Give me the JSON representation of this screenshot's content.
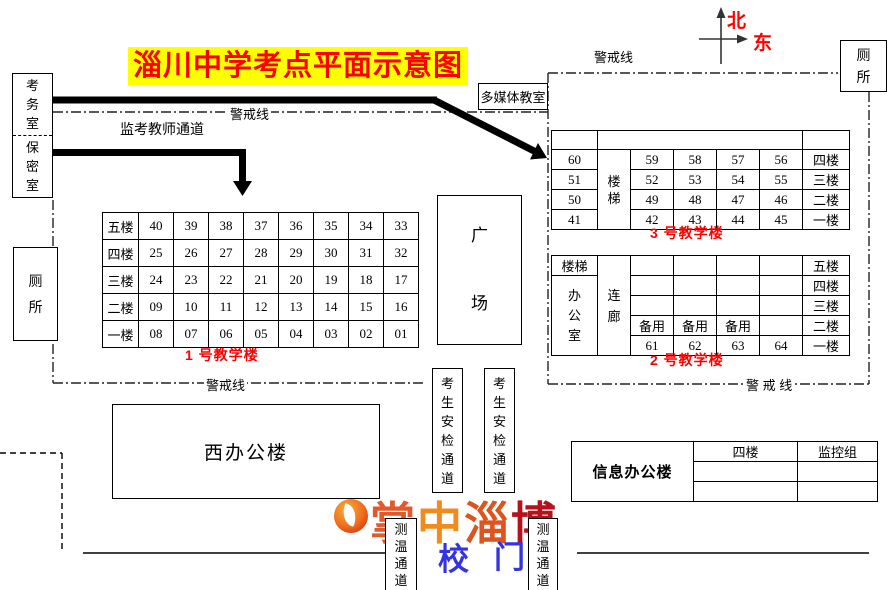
{
  "title": "淄川中学考点平面示意图",
  "compass": {
    "north": "北",
    "east": "东"
  },
  "rooms": {
    "exam_office": "考务室",
    "secrecy_room": "保密室",
    "toilet_left": "厕所",
    "toilet_top_right": "厕所",
    "multimedia": "多媒体教室",
    "square": "广场",
    "west_office": "西办公楼",
    "info_office": "信息办公楼"
  },
  "labels": {
    "cordon_top_left": "警戒线",
    "cordon_top_right": "警戒线",
    "cordon_bottom_left": "警戒线",
    "cordon_bottom_right": "警 戒 线",
    "teacher_passage": "监考教师通道",
    "security_channel": "考生安检通道",
    "temp_channel": "测温通道",
    "gate_left": "校",
    "gate_right": "门"
  },
  "building1": {
    "name": "1 号教学楼",
    "floors": [
      "五楼",
      "四楼",
      "三楼",
      "二楼",
      "一楼"
    ],
    "rows": [
      [
        "40",
        "39",
        "38",
        "37",
        "36",
        "35",
        "34",
        "33"
      ],
      [
        "25",
        "26",
        "27",
        "28",
        "29",
        "30",
        "31",
        "32"
      ],
      [
        "24",
        "23",
        "22",
        "21",
        "20",
        "19",
        "18",
        "17"
      ],
      [
        "09",
        "10",
        "11",
        "12",
        "13",
        "14",
        "15",
        "16"
      ],
      [
        "08",
        "07",
        "06",
        "05",
        "04",
        "03",
        "02",
        "01"
      ]
    ]
  },
  "building3": {
    "name": "3 号教学楼",
    "stairs": "楼梯",
    "floors": [
      "四楼",
      "三楼",
      "二楼",
      "一楼"
    ],
    "left_col": [
      "60",
      "51",
      "50",
      "41"
    ],
    "rows": [
      [
        "59",
        "58",
        "57",
        "56"
      ],
      [
        "52",
        "53",
        "54",
        "55"
      ],
      [
        "49",
        "48",
        "47",
        "46"
      ],
      [
        "42",
        "43",
        "44",
        "45"
      ]
    ]
  },
  "building2": {
    "name": "2 号教学楼",
    "stairs": "楼梯",
    "office": "办公室",
    "corridor": "连廊",
    "floors": [
      "五楼",
      "四楼",
      "三楼",
      "二楼",
      "一楼"
    ],
    "backup_row": [
      "备用",
      "备用",
      "备用",
      ""
    ],
    "room_row": [
      "61",
      "62",
      "63",
      "64"
    ]
  },
  "info_table": {
    "headers": [
      "四楼",
      "监控组"
    ]
  },
  "watermark": {
    "text": "掌中淄博",
    "chars": [
      "掌",
      "中",
      "淄",
      "博"
    ]
  },
  "colors": {
    "room_yellow": "#FFFF00",
    "floor_blue": "#00AEEF",
    "stairs_green": "#00A651",
    "accent_red": "#FF0000",
    "gate_blue": "#3535E0"
  }
}
